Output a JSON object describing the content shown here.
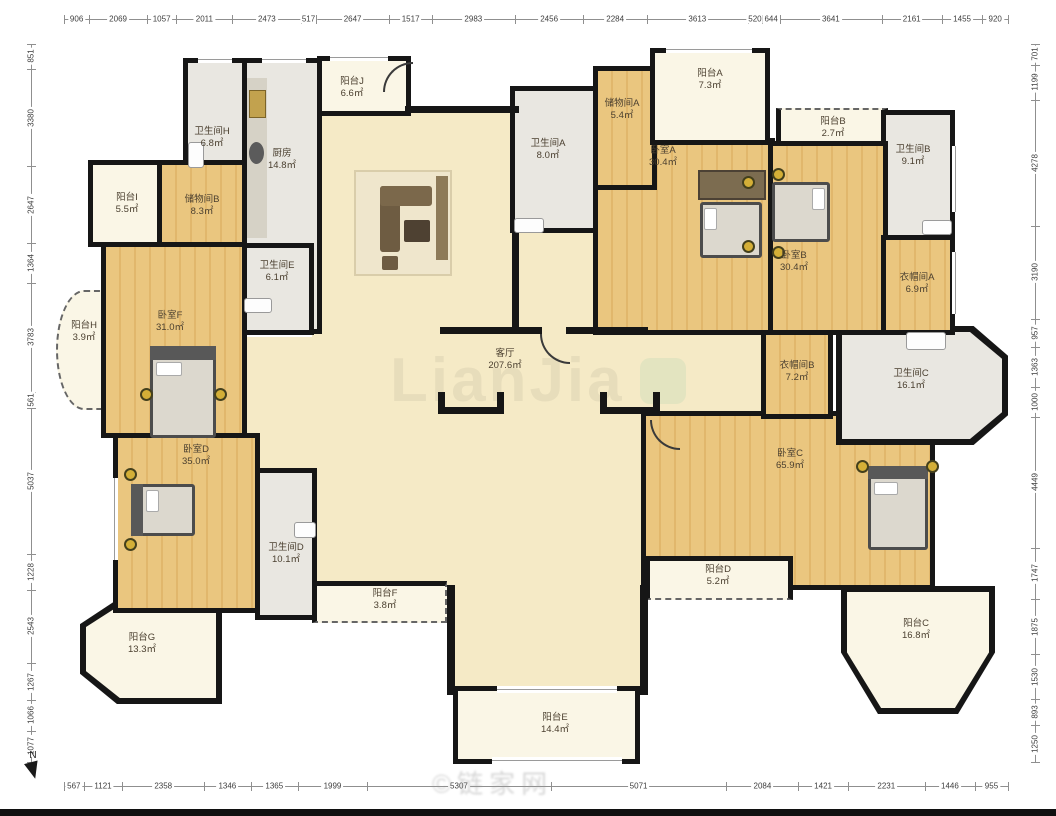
{
  "watermarks": {
    "center": "LianJia",
    "bottom": "©链家网"
  },
  "compass": {
    "label": "N"
  },
  "colors": {
    "wall": "#161616",
    "livfill": "#f5eac6",
    "bedfill": "#eac67f",
    "bedline": "#e1b76c",
    "bathfill": "#e9e7e1",
    "balcfill": "#faf6e6",
    "labeltext": "#4a3f2f"
  },
  "rulers": {
    "top": [
      906,
      2069,
      1057,
      2011,
      2473,
      517,
      2647,
      1517,
      2983,
      2456,
      2284,
      3613,
      520,
      644,
      3641,
      2161,
      1455,
      920
    ],
    "bottom": [
      567,
      1121,
      2358,
      1346,
      1365,
      1999,
      5307,
      5071,
      2084,
      1421,
      2231,
      1446,
      955
    ],
    "left": [
      851,
      3380,
      2647,
      1364,
      3783,
      561,
      5037,
      1228,
      2543,
      1267,
      1066,
      1077
    ],
    "right": [
      701,
      1199,
      4278,
      3190,
      957,
      1363,
      1000,
      4449,
      1747,
      1875,
      1530,
      893,
      1250
    ]
  },
  "rooms": [
    {
      "name": "卫生间H",
      "area": "6.8㎡"
    },
    {
      "name": "厨房",
      "area": "14.8㎡"
    },
    {
      "name": "阳台J",
      "area": "6.6㎡"
    },
    {
      "name": "阳台I",
      "area": "5.5㎡"
    },
    {
      "name": "储物间B",
      "area": "8.3㎡"
    },
    {
      "name": "卫生间E",
      "area": "6.1㎡"
    },
    {
      "name": "卧室F",
      "area": "31.0㎡"
    },
    {
      "name": "阳台H",
      "area": "3.9㎡"
    },
    {
      "name": "卧室D",
      "area": "35.0㎡"
    },
    {
      "name": "卫生间D",
      "area": "10.1㎡"
    },
    {
      "name": "阳台G",
      "area": "13.3㎡"
    },
    {
      "name": "阳台F",
      "area": "3.8㎡"
    },
    {
      "name": "阳台E",
      "area": "14.4㎡"
    },
    {
      "name": "客厅",
      "area": "207.6㎡"
    },
    {
      "name": "卫生间A",
      "area": "8.0㎡"
    },
    {
      "name": "储物间A",
      "area": "5.4㎡"
    },
    {
      "name": "卧室A",
      "area": "30.4㎡"
    },
    {
      "name": "阳台A",
      "area": "7.3㎡"
    },
    {
      "name": "阳台B",
      "area": "2.7㎡"
    },
    {
      "name": "卫生间B",
      "area": "9.1㎡"
    },
    {
      "name": "卧室B",
      "area": "30.4㎡"
    },
    {
      "name": "衣帽间A",
      "area": "6.9㎡"
    },
    {
      "name": "衣帽间B",
      "area": "7.2㎡"
    },
    {
      "name": "卫生间C",
      "area": "16.1㎡"
    },
    {
      "name": "卧室C",
      "area": "65.9㎡"
    },
    {
      "name": "阳台D",
      "area": "5.2㎡"
    },
    {
      "name": "阳台C",
      "area": "16.8㎡"
    }
  ]
}
